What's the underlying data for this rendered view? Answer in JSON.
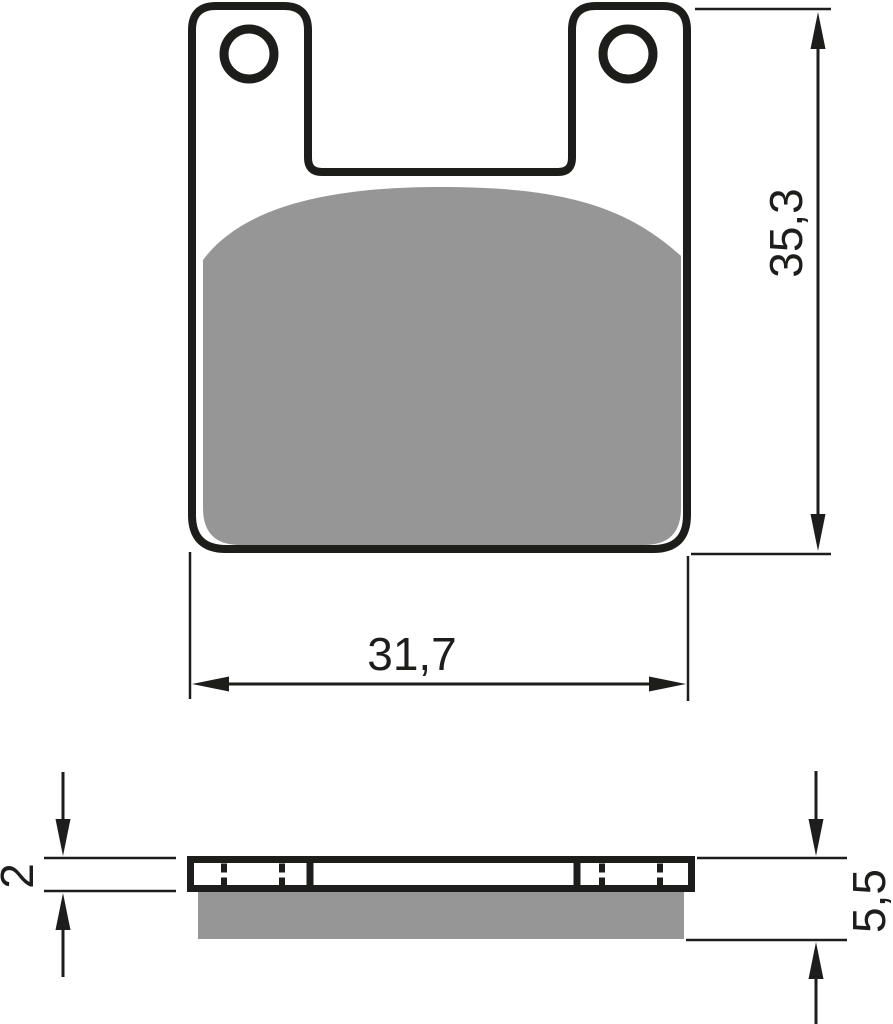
{
  "drawing": {
    "colors": {
      "line": "#1d1d1b",
      "friction_material": "#969696",
      "background": "#ffffff"
    },
    "front_view": {
      "width_dimension": "31,7",
      "height_dimension": "35,3"
    },
    "section_view": {
      "backplate_thickness": "2",
      "total_thickness": "5,5"
    }
  }
}
